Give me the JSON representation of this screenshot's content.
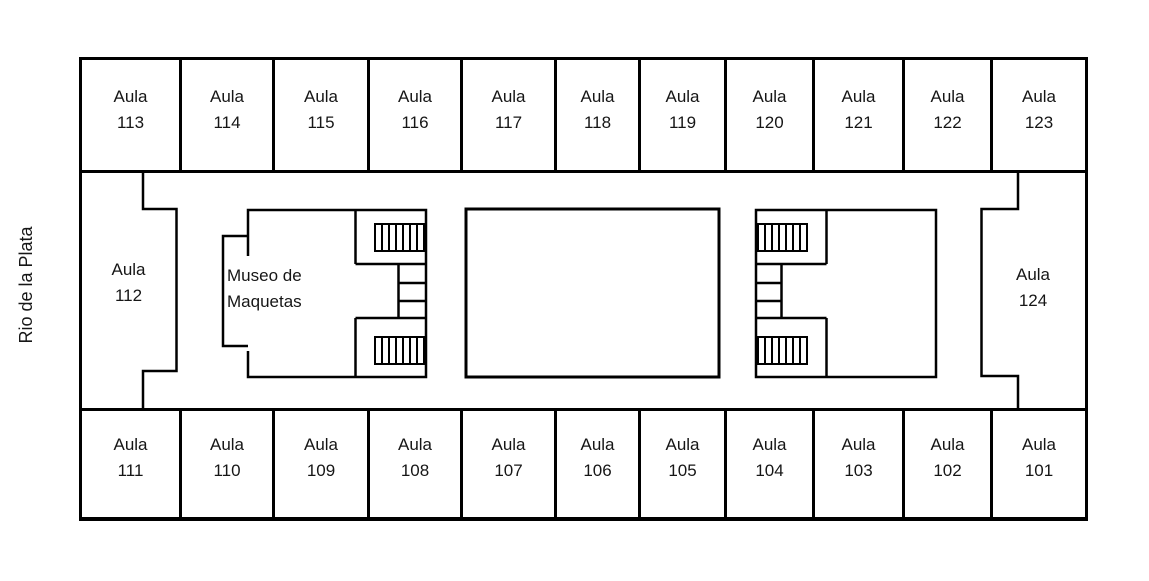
{
  "river_label": "Rio de la Plata",
  "museum": {
    "line1": "Museo de",
    "line2": "Maquetas"
  },
  "rooms": {
    "top_row": [
      {
        "prefix": "Aula",
        "number": "113"
      },
      {
        "prefix": "Aula",
        "number": "114"
      },
      {
        "prefix": "Aula",
        "number": "115"
      },
      {
        "prefix": "Aula",
        "number": "116"
      },
      {
        "prefix": "Aula",
        "number": "117"
      },
      {
        "prefix": "Aula",
        "number": "118"
      },
      {
        "prefix": "Aula",
        "number": "119"
      },
      {
        "prefix": "Aula",
        "number": "120"
      },
      {
        "prefix": "Aula",
        "number": "121"
      },
      {
        "prefix": "Aula",
        "number": "122"
      },
      {
        "prefix": "Aula",
        "number": "123"
      }
    ],
    "bottom_row": [
      {
        "prefix": "Aula",
        "number": "111"
      },
      {
        "prefix": "Aula",
        "number": "110"
      },
      {
        "prefix": "Aula",
        "number": "109"
      },
      {
        "prefix": "Aula",
        "number": "108"
      },
      {
        "prefix": "Aula",
        "number": "107"
      },
      {
        "prefix": "Aula",
        "number": "106"
      },
      {
        "prefix": "Aula",
        "number": "105"
      },
      {
        "prefix": "Aula",
        "number": "104"
      },
      {
        "prefix": "Aula",
        "number": "103"
      },
      {
        "prefix": "Aula",
        "number": "102"
      },
      {
        "prefix": "Aula",
        "number": "101"
      }
    ],
    "left_room": {
      "prefix": "Aula",
      "number": "112"
    },
    "right_room": {
      "prefix": "Aula",
      "number": "124"
    }
  },
  "colors": {
    "wall": "#000000",
    "text": "#161616",
    "background": "#ffffff"
  }
}
